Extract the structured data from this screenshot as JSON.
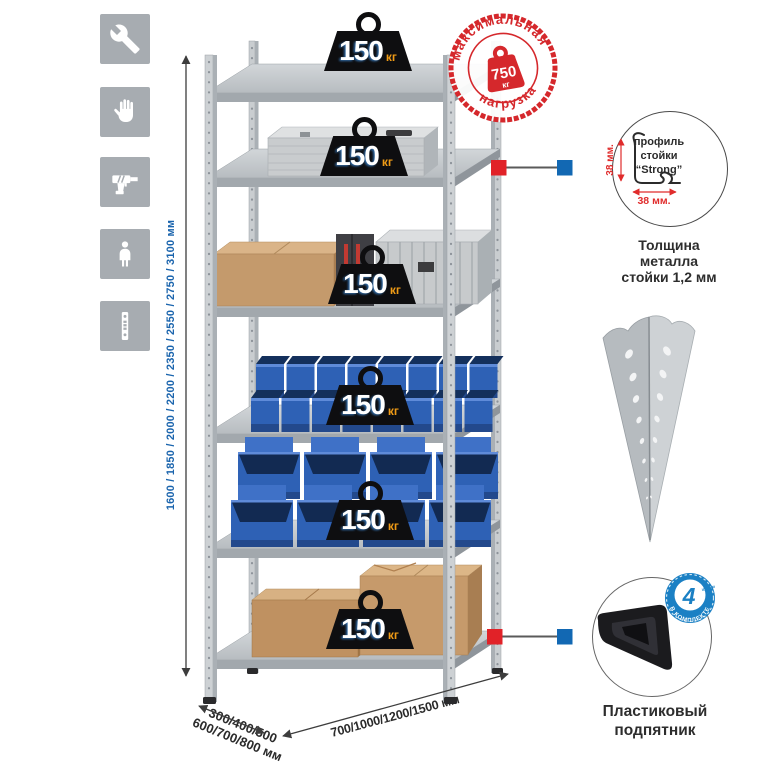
{
  "canvas": {
    "background": "#ffffff"
  },
  "assembly_icons": [
    {
      "name": "wrench"
    },
    {
      "name": "gloves"
    },
    {
      "name": "drill"
    },
    {
      "name": "person"
    },
    {
      "name": "perforated-strip"
    }
  ],
  "dimensions": {
    "height_label": "1600 / 1850 / 2000 / 2200 / 2350 / 2550 / 2750 / 3100 мм",
    "depth_label_line1": "300/400/500",
    "depth_label_line2": "600/700/800 мм",
    "width_label": "700/1000/1200/1500 мм"
  },
  "shelf_badges": [
    {
      "value": "150",
      "unit": "кг"
    },
    {
      "value": "150",
      "unit": "кг"
    },
    {
      "value": "150",
      "unit": "кг"
    },
    {
      "value": "150",
      "unit": "кг"
    },
    {
      "value": "150",
      "unit": "кг"
    },
    {
      "value": "150",
      "unit": "кг"
    }
  ],
  "max_load_stamp": {
    "arc_top": "максимальная",
    "arc_bottom": "нагрузка",
    "value": "750",
    "unit": "кг"
  },
  "profile_callout": {
    "label_line1": "профиль",
    "label_line2": "стойки",
    "label_line3": "“Strong”",
    "vertical_dim": "38 мм.",
    "horizontal_dim": "38 мм.",
    "caption_line1": "Толщина металла",
    "caption_line2": "стойки 1,2 мм"
  },
  "foot_callout": {
    "badge_number": "4",
    "badge_small_text": "штуки",
    "badge_arc_text": "в комплекте",
    "caption_line1": "Пластиковый",
    "caption_line2": "подпятник"
  },
  "colors": {
    "accent_blue": "#1a64ad",
    "stamp_red": "#d5282c",
    "marker_red": "#e12228",
    "marker_blue": "#1268b3",
    "badge_orange": "#ef9b16",
    "icon_gray": "#a7acb1",
    "bin_blue": "#2e61b5"
  }
}
